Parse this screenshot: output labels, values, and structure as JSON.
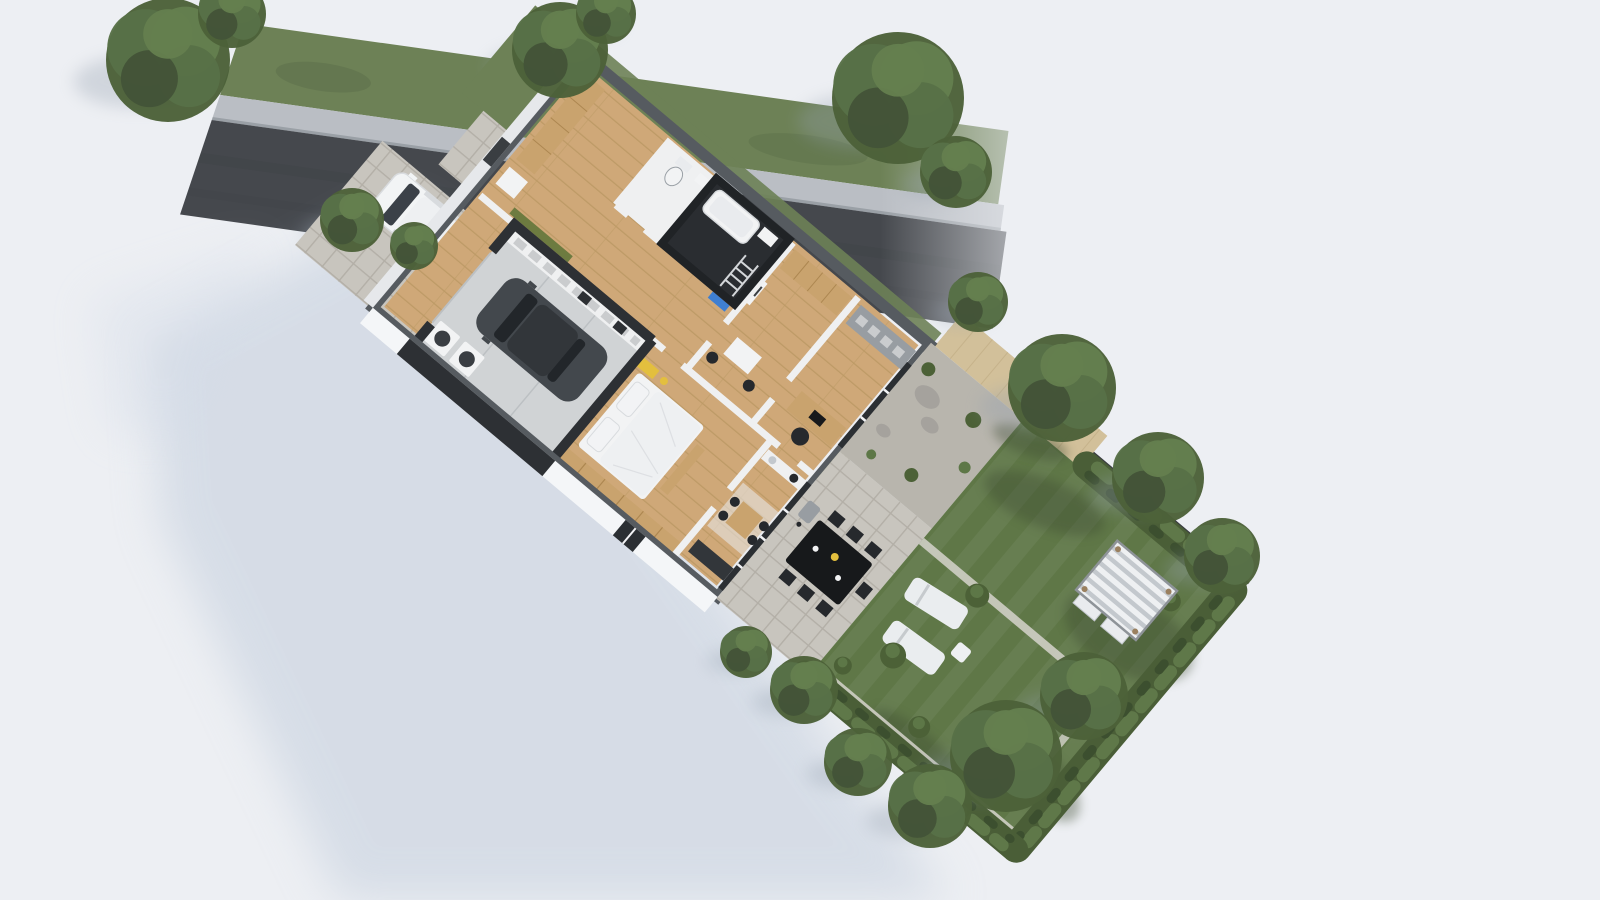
{
  "meta": {
    "scene_type": "aerial-3d-site-plan-render",
    "description": "top-down 3d cutaway floor plan of a single family house with street, driveway, garage and garden"
  },
  "palette": {
    "bg": "#edeff3",
    "shadowBlue": "#c7d1df",
    "shadowBlue2": "#d4dce8",
    "road": "#45484d",
    "roadDark": "#3c4045",
    "sidewalk": "#babec4",
    "curb": "#9aa0a6",
    "verge": "#6d8156",
    "vergeDark": "#5b6d49",
    "paver": "#c8c5be",
    "paverLine": "#b3afa7",
    "wood": "#cfa878",
    "woodLine": "#bd9a66",
    "wardrobe": "#c9a36e",
    "wardrobeLine": "#ad8751",
    "wallOuter": "#565b60",
    "wallInner": "#eff0f1",
    "wallDark": "#2d3034",
    "bathWall": "#202326",
    "bathFloor": "#2a2d31",
    "facade": "#f4f6f8",
    "facadeSide": "#e6e8eb",
    "doorDark": "#3a3e42",
    "glass": "#2b2f33",
    "mullion": "#f2f3f5",
    "concrete": "#d0d3d5",
    "concreteLine": "#bcc0c3",
    "white": "#f2f3f4",
    "offWhite": "#e9ebee",
    "grayUnit": "#989da2",
    "lawn": "#5f7747",
    "lawnStripe": "#ffffff",
    "lawnShade": "#3c4c30",
    "hedge": "#4a5e37",
    "hedgeHi": "#5f7849",
    "hedgeLo": "#3c4f2f",
    "shrub": "#4c6137",
    "shrubHi": "#5d7747",
    "gravel": "#b8b5ad",
    "boulder": "#a5a29d",
    "fenceWood": "#d2c09a",
    "fenceWoodLine": "#c1ad84",
    "fenceLine": "#3b3e41",
    "tableBlack": "#17191b",
    "chairDark": "#26292d",
    "car": "#43484d",
    "carGlass": "#22262a",
    "carRoof": "#32363a",
    "van": "#f2f4f5",
    "vanGlass": "#3b4148",
    "vanTrim": "#d8dbde",
    "accentYellow": "#e3bf3e",
    "accentBlue": "#3f7fd1",
    "olive": "#6d7b40",
    "lounger": "#eaedef",
    "loungerLine": "#c6cacd",
    "pergolaA": "#eef0f2",
    "pergolaB": "#c3c8cd",
    "pergolaFrame": "#8e9398",
    "pergolaWood": "#9a805f",
    "applianceDrum": "#3a3e43",
    "pathStone": "#d6d4cc",
    "treeBase": "#4c6139",
    "treeMid": "#587147",
    "treeHi": "#647f4e",
    "treeLo": "#435438",
    "treeShadow": "#94a0af",
    "ladder": "#d3d6d9",
    "shelfBox": "#caccce"
  },
  "scene": {
    "trees": [
      {
        "x": 168,
        "y": 60,
        "r": 62,
        "layer": "under"
      },
      {
        "x": 232,
        "y": 14,
        "r": 34,
        "layer": "under"
      },
      {
        "x": 560,
        "y": 50,
        "r": 48,
        "layer": "under"
      },
      {
        "x": 606,
        "y": 14,
        "r": 30,
        "layer": "under"
      },
      {
        "x": 898,
        "y": 98,
        "r": 66,
        "layer": "under"
      },
      {
        "x": 956,
        "y": 172,
        "r": 36,
        "layer": "under"
      },
      {
        "x": 352,
        "y": 220,
        "r": 32,
        "layer": "under"
      },
      {
        "x": 414,
        "y": 246,
        "r": 24,
        "layer": "under"
      },
      {
        "x": 978,
        "y": 302,
        "r": 30,
        "layer": "over"
      },
      {
        "x": 1062,
        "y": 388,
        "r": 54,
        "layer": "over"
      },
      {
        "x": 1158,
        "y": 478,
        "r": 46,
        "layer": "over"
      },
      {
        "x": 1222,
        "y": 556,
        "r": 38,
        "layer": "over"
      },
      {
        "x": 1084,
        "y": 696,
        "r": 44,
        "layer": "over"
      },
      {
        "x": 1006,
        "y": 756,
        "r": 56,
        "layer": "over"
      },
      {
        "x": 930,
        "y": 806,
        "r": 42,
        "layer": "over"
      },
      {
        "x": 858,
        "y": 762,
        "r": 34,
        "layer": "over"
      },
      {
        "x": 804,
        "y": 690,
        "r": 34,
        "layer": "over"
      },
      {
        "x": 746,
        "y": 652,
        "r": 26,
        "layer": "over"
      }
    ],
    "bushes": [
      {
        "x": 648,
        "y": 162,
        "r": 12
      },
      {
        "x": 622,
        "y": 262,
        "r": 13
      },
      {
        "x": 688,
        "y": 300,
        "r": 11
      },
      {
        "x": 590,
        "y": 302,
        "r": 9
      },
      {
        "x": 800,
        "y": 42,
        "r": 10
      }
    ],
    "lawn_shade": [
      {
        "x": 640,
        "y": 48,
        "rx": 64,
        "ry": 24,
        "rot": -18
      },
      {
        "x": 790,
        "y": 95,
        "rx": 70,
        "ry": 38,
        "rot": -12
      },
      {
        "x": 812,
        "y": 262,
        "rx": 55,
        "ry": 26,
        "rot": 8
      },
      {
        "x": 700,
        "y": 318,
        "rx": 58,
        "ry": 18,
        "rot": 0
      },
      {
        "x": 590,
        "y": 10,
        "rx": 40,
        "ry": 14,
        "rot": -20
      }
    ],
    "lawn_stripes": {
      "count": 8,
      "x0": 574,
      "width": 17,
      "gap": 34,
      "y": 0,
      "height": 330
    },
    "counts": {
      "patio_chairs": 7,
      "loungers": 2,
      "washer_dryer": 2
    }
  }
}
